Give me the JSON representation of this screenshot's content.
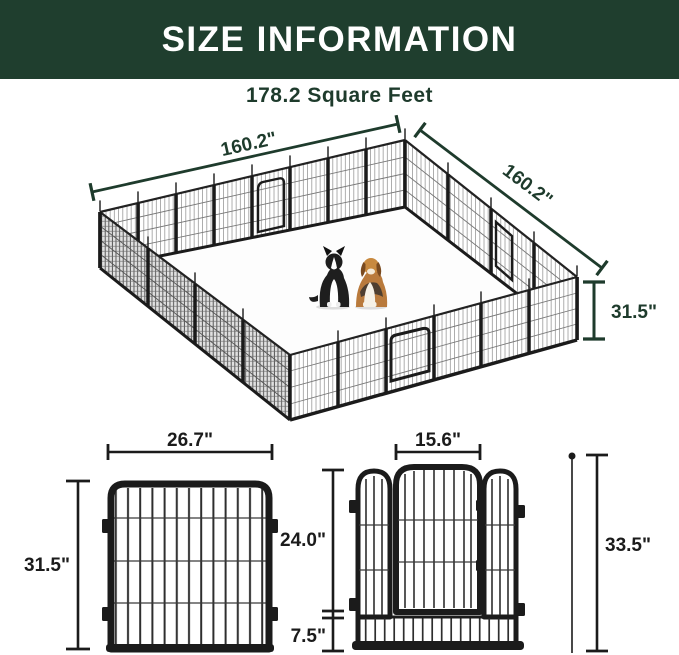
{
  "header": {
    "title": "SIZE INFORMATION"
  },
  "subtitle": {
    "text": "178.2 Square Feet"
  },
  "colors": {
    "header_bg": "#1F3E2E",
    "accent_green": "#1E3B2C",
    "line_black": "#1B1B1B",
    "page_bg": "#FFFFFF",
    "dog_beagle_tan": "#C8893F",
    "dog_collie_black": "#1E1E1E"
  },
  "pen_diagram": {
    "dim_side_left": "160.2\"",
    "dim_side_right": "160.2\"",
    "dim_height": "31.5\"",
    "dogs": [
      {
        "icon": "border-collie-dog"
      },
      {
        "icon": "beagle-dog"
      }
    ]
  },
  "panel_diagram": {
    "dim_width": "26.7\"",
    "dim_height": "31.5\""
  },
  "door_panel_diagram": {
    "dim_door_width": "15.6\"",
    "dim_door_height": "24.0\"",
    "dim_bottom_height": "7.5\"",
    "dim_total_height": "33.5\""
  }
}
